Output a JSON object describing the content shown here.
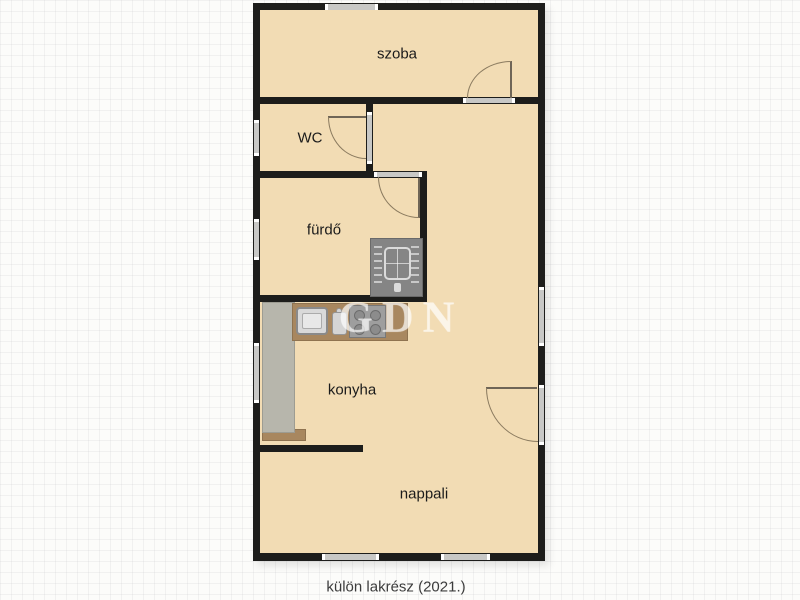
{
  "plan": {
    "caption": "külön lakrész (2021.)",
    "watermark": "GDN",
    "rooms": [
      {
        "id": "szoba",
        "label": "szoba"
      },
      {
        "id": "wc",
        "label": "WC"
      },
      {
        "id": "furdo",
        "label": "fürdő"
      },
      {
        "id": "konyha",
        "label": "konyha"
      },
      {
        "id": "nappali",
        "label": "nappali"
      }
    ],
    "fixtures": {
      "sink": "kitchen-sink",
      "cutting_board": "cutting-board",
      "stove": "stove-cooktop",
      "cabinet": "kitchen-cabinet",
      "counter": "kitchen-counter",
      "washing_machine": "washing-machine"
    },
    "doors": [
      "szoba-door",
      "wc-door",
      "furdo-door",
      "nappali-door"
    ],
    "windows_count": 7
  },
  "colors": {
    "floor": "#f2dcb4",
    "wall": "#1d1d1b",
    "window": "#c8c8c6",
    "door_arc": "#8a7a5f",
    "counter_wood": "#a8875f",
    "cabinet": "#b7b6ac",
    "appliance_gray": "#858585",
    "background": "#fcfcfa"
  }
}
